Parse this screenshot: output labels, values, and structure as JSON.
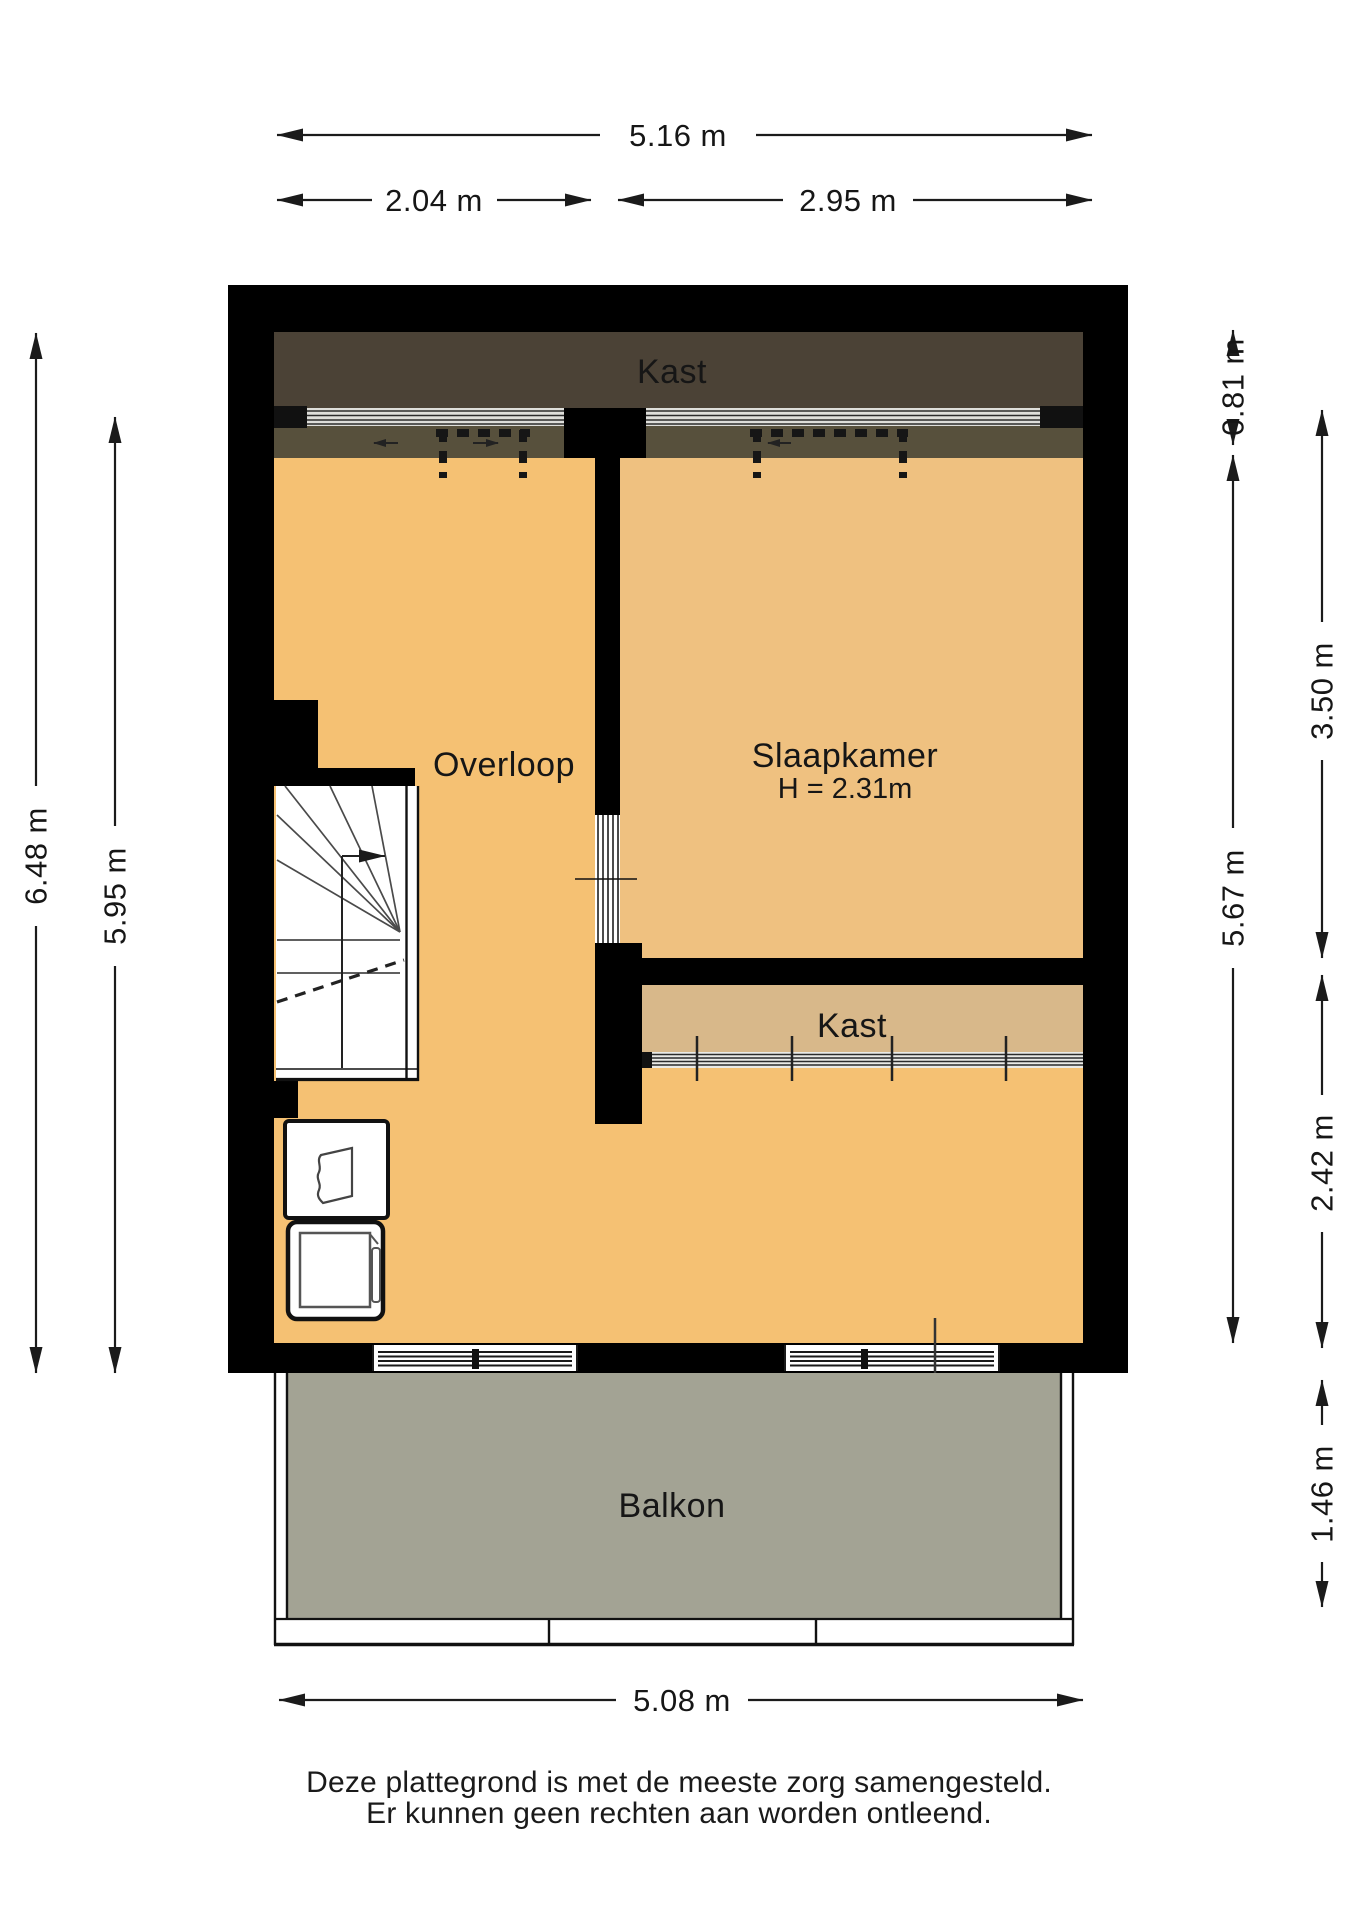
{
  "rooms": {
    "kast_top": "Kast",
    "overloop": "Overloop",
    "slaapkamer": "Slaapkamer",
    "slaapkamer_height": "H = 2.31m",
    "kast_mid": "Kast",
    "balkon": "Balkon"
  },
  "dimensions": {
    "top_total": "5.16 m",
    "top_left": "2.04 m",
    "top_right": "2.95 m",
    "left_outer": "6.48 m",
    "left_inner": "5.95 m",
    "right_top": "0.81 m",
    "right_upper": "3.50 m",
    "right_inner": "5.67 m",
    "right_lower": "2.42 m",
    "right_balcony": "1.46 m",
    "bottom_total": "5.08 m"
  },
  "disclaimer": {
    "line1": "Deze plattegrond is met de meeste zorg samengesteld.",
    "line2": "Er kunnen geen rechten aan worden ontleend."
  },
  "colors": {
    "wall": "#000000",
    "floor_orange": "#F5C173",
    "floor_slaapkamer": "#EFC180",
    "closet_dark": "#4B4236",
    "closet_dark_lower": "#57503C",
    "closet_tan": "#D8B88A",
    "balcony_gray": "#A3A394",
    "rail_light": "#DEDEDA"
  }
}
